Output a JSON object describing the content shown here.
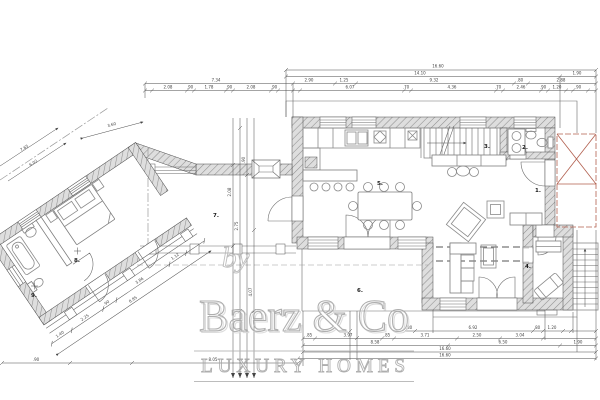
{
  "watermark": {
    "by": "by",
    "brand": "Baerz & Co",
    "tagline": "LUXURY HOMES"
  },
  "rooms": {
    "hall": "1.",
    "wc": "2.",
    "stairs": "3.",
    "study": "4.",
    "dining": "5.",
    "terrace": "6.",
    "patio": "7.",
    "bedroom": "8.",
    "bathroom": "9."
  },
  "dims": {
    "row1_total": "16.60",
    "row2": [
      "14.10",
      "1.90"
    ],
    "row3_left_total": "7.34",
    "row3": [
      "2.90",
      "1.25",
      "9.32",
      ".80",
      "2.88"
    ],
    "row4_left": [
      "2.08",
      ".90",
      "1.78",
      ".90",
      "2.08",
      ".90"
    ],
    "row4_right": [
      "6.07",
      ".70",
      "4.36",
      ".70",
      "2.46",
      ".90",
      "1.20",
      ".90"
    ],
    "bottom1": [
      ".80",
      "6.92",
      ".80",
      "1.20"
    ],
    "bottom2": [
      ".85",
      "3.97",
      ".85",
      "3.71",
      "2.50",
      "3.04"
    ],
    "bottom3": [
      "8.58",
      "6.50",
      "1.90"
    ],
    "bottom_total_a": "16.60",
    "bottom_total_b": "16.60",
    "sw_seg": ".90",
    "sw_total": "8.05",
    "wing_segs": [
      "1.40",
      "2.25",
      ".90",
      "3.86",
      "1.12"
    ],
    "wing_total": "8.85",
    "wing_upper": "3.60",
    "wing_left": [
      "7.65",
      "6.02"
    ],
    "vchain": [
      "2.08",
      "2.75",
      ".90",
      "4.07"
    ]
  }
}
